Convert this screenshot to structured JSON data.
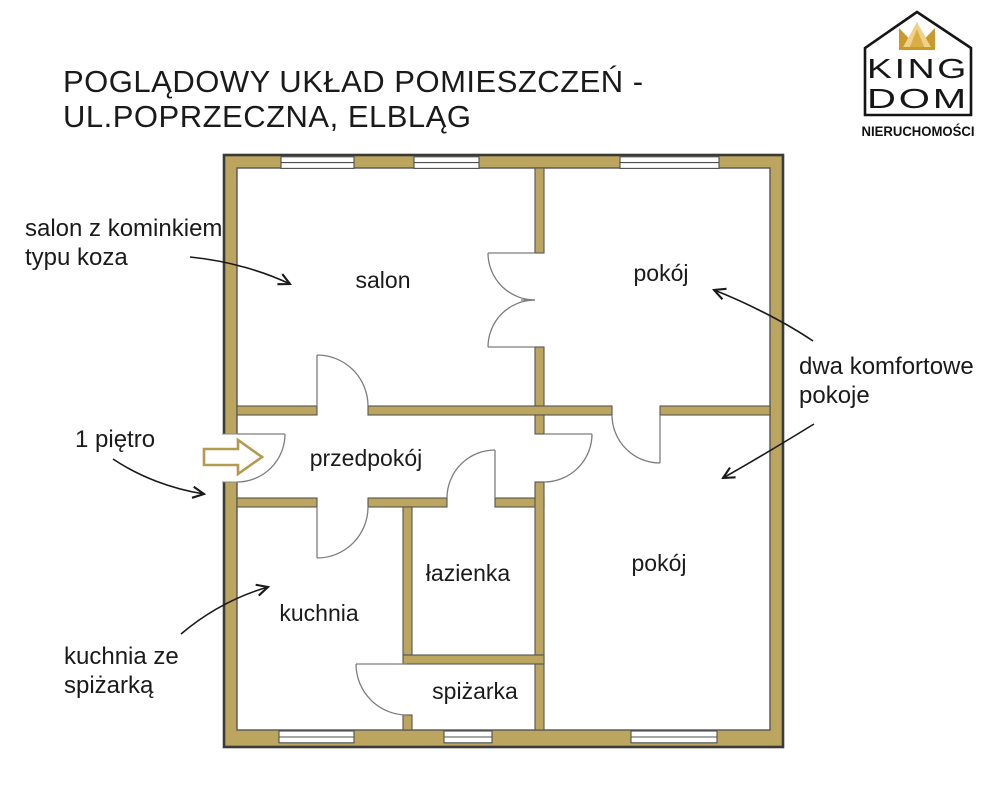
{
  "title": {
    "line1": "POGLĄDOWY UKŁAD POMIESZCZEŃ -",
    "line2": "UL.POPRZECZNA, ELBLĄG"
  },
  "logo": {
    "king": "KING",
    "dom": "DOM",
    "subtitle": "NIERUCHOMOŚCI"
  },
  "rooms": {
    "salon": "salon",
    "room_top": "pokój",
    "hallway": "przedpokój",
    "bathroom": "łazienka",
    "kitchen": "kuchnia",
    "pantry": "spiżarka",
    "room_bottom": "pokój"
  },
  "annotations": {
    "fireplace": {
      "line1": "salon z kominkiem",
      "line2": "typu koza"
    },
    "floor": "1 piętro",
    "kitchen_pantry": {
      "line1": "kuchnia ze",
      "line2": "spiżarką"
    },
    "two_rooms": {
      "line1": "dwa komfortowe",
      "line2": "pokoje"
    }
  },
  "colors": {
    "wall": "#BCA55E",
    "outer_outline": "#3A3A3A",
    "inner_outline": "#555555",
    "door_line": "#7D7D7D",
    "entry_arrow_outline": "#B49A4E",
    "logo_gold_dark": "#C9992B",
    "logo_gold_mid": "#D9AE43",
    "logo_gold_light": "#EFD28A",
    "text": "#1A1A1A"
  }
}
